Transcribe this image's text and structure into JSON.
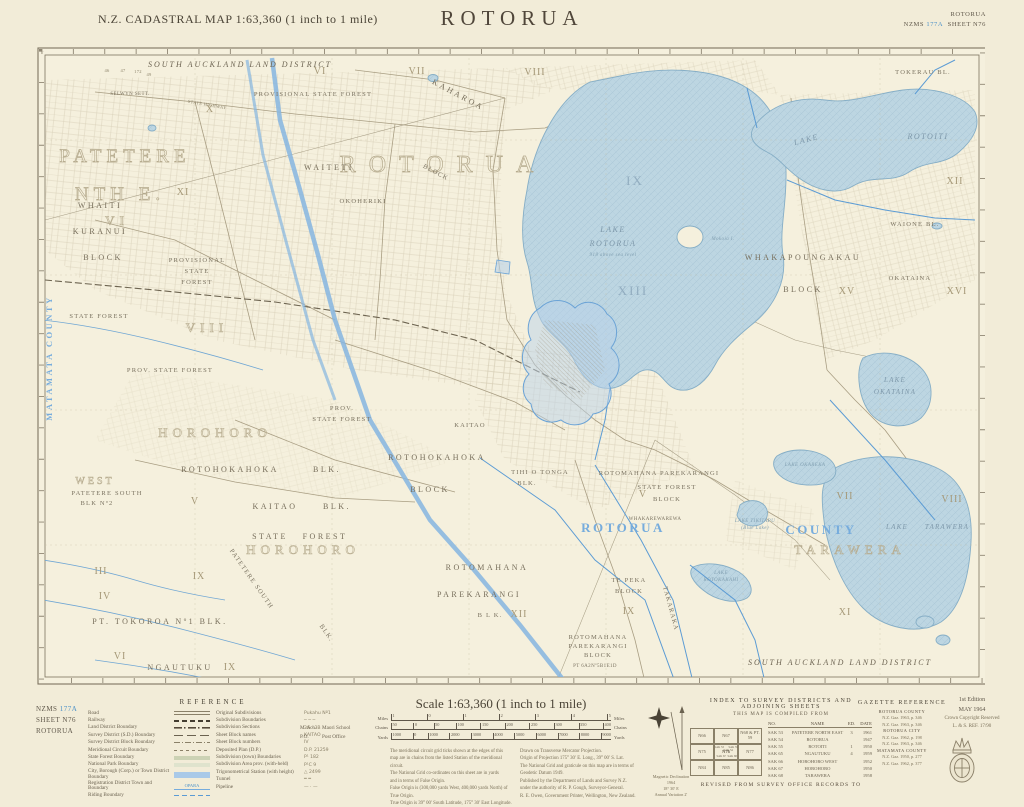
{
  "header": {
    "title": "N.Z. CADASTRAL MAP 1:63,360 (1 inch to 1 mile)",
    "name": "ROTORUA",
    "corner_title": "ROTORUA",
    "series_prefix": "NZMS ",
    "series_no": "177A",
    "sheet": "SHEET N76"
  },
  "footer": {
    "sheet_id": {
      "prefix": "NZMS ",
      "no": "177A",
      "sheet": "SHEET N76",
      "name": "ROTORUA"
    },
    "reference": {
      "title": "REFERENCE",
      "col1": [
        {
          "label": "Road",
          "sw": "sw-road",
          "sample": ""
        },
        {
          "label": "Railway",
          "sw": "sw-rail",
          "sample": ""
        },
        {
          "label": "Land District Boundary",
          "sw": "sw-dashdot-heavy",
          "sample": ""
        },
        {
          "label": "Survey District (S.D.) Boundary",
          "sw": "sw-dash-long",
          "sample": ""
        },
        {
          "label": "Survey District Block Boundary",
          "sw": "sw-dashdot",
          "sample": ""
        },
        {
          "label": "Meridional Circuit Boundary",
          "sw": "sw-dash-fine",
          "sample": ""
        },
        {
          "label": "State Forest Boundary",
          "sw": "sw-band-forest",
          "sample": ""
        },
        {
          "label": "National Park Boundary",
          "sw": "sw-band-park",
          "sample": ""
        },
        {
          "label": "City, Borough (Corp.) or Town District Boundary",
          "sw": "sw-band-blue",
          "sample": ""
        },
        {
          "label": "Registration District Town and Boundary",
          "sw": "sw-bluetown",
          "sample": "OPARA"
        },
        {
          "label": "Riding Boundary",
          "sw": "sw-bluedash",
          "sample": ""
        }
      ],
      "col2": [
        {
          "label": "Original Subdivisions",
          "sample": "Pukahu Nº1"
        },
        {
          "label": "Subdivision Boundaries",
          "sample": "─ ─ ─"
        },
        {
          "label": "Subdivision Sections",
          "sample": "3A · 3B"
        },
        {
          "label": "Sheet Block names",
          "sample": "KAITAO"
        },
        {
          "label": "Sheet Block numbers",
          "sample": "IV"
        },
        {
          "label": "Deposited Plan (D.P.)",
          "sample": "D.P. 21259"
        },
        {
          "label": "Subdivision (town) Boundaries",
          "sample": "P¹ 182"
        },
        {
          "label": "Subdivision Area prov. (with-held)",
          "sample": "P¹C 9"
        },
        {
          "label": "Trigonometrical Station (with height)",
          "sample": "△ 2499"
        },
        {
          "label": "Tunnel",
          "sample": "═ ═"
        },
        {
          "label": "Pipeline",
          "sample": "— · —"
        }
      ],
      "abbr": [
        {
          "a": "M. Sch.",
          "l": "Maori School"
        },
        {
          "a": "P.O.",
          "l": "Post Office"
        }
      ]
    },
    "scale": {
      "title": "Scale 1:63,360 (1 inch to 1 mile)",
      "miles": {
        "unit": "Miles",
        "unit2": "Miles",
        "ticks": [
          "1",
          "0",
          "1",
          "2",
          "3",
          "4",
          "5"
        ]
      },
      "chains": {
        "unit": "Chains",
        "unit2": "Chains",
        "ticks": [
          "50",
          "0",
          "50",
          "100",
          "150",
          "200",
          "250",
          "300",
          "350",
          "400"
        ]
      },
      "yards": {
        "unit": "Yards",
        "unit2": "Yards",
        "ticks": [
          "1000",
          "0",
          "1000",
          "2000",
          "3000",
          "4000",
          "5000",
          "6000",
          "7000",
          "8000",
          "9000"
        ]
      },
      "notes_left": [
        "The meridional circuit grid ticks shown at the edges of this",
        "map are in chains from the listed Station of the meridional circuit.",
        "The National Grid co-ordinates on this sheet are in yards",
        "and in terms of False Origin.",
        "False Origin is (300,000 yards West, 400,000 yards North) of True Origin.",
        "True Origin is 39° 00′ South Latitude, 175° 30′ East Longitude."
      ],
      "notes_right": [
        "Drawn on Transverse Mercator Projection.",
        "Origin of Projection 175° 30′ E. Long., 39° 00′ S. Lat.",
        "The National Grid and graticule on this map are in terms of",
        "Geodetic Datum 1949.",
        "Published by the Department of Lands and Survey N.Z.",
        "under the authority of R. P. Gough, Surveyor-General.",
        "R. E. Owen, Government Printer, Wellington, New Zealand."
      ]
    },
    "compass": {
      "declination": [
        "Magnetic Declination",
        "1964",
        "18° 30′ E",
        "Annual Variation 2′"
      ]
    },
    "index": {
      "title": "INDEX TO SURVEY DISTRICTS AND ADJOINING SHEETS",
      "subtitle": "THIS MAP IS COMPILED FROM",
      "columns": [
        "NO.",
        "NAME",
        "ED.",
        "DATE"
      ],
      "rows": [
        [
          "SAK 53",
          "PATETERE NORTH EAST",
          "3",
          "1961"
        ],
        [
          "SAK 54",
          "ROTORUA",
          "",
          "1947"
        ],
        [
          "SAK 55",
          "ROTOITI",
          "1",
          "1950"
        ],
        [
          "SAK 65",
          "NGAUTUKU",
          "4",
          "1959"
        ],
        [
          "SAK 66",
          "HOROHORO WEST",
          "",
          "1952"
        ],
        [
          "SAK 67",
          "HOROHORO",
          "",
          "1950"
        ],
        [
          "SAK 68",
          "TARAWERA",
          "",
          "1958"
        ]
      ],
      "grid": [
        "N66",
        "N67",
        "N68 & PT. 59",
        "N75",
        "N76",
        "N77",
        "N84",
        "N85",
        "N86"
      ],
      "inner": [
        "SAK 53",
        "SAK 54",
        "SAK 55",
        "SAK 67",
        "SAK 68"
      ],
      "revised": "REVISED FROM SURVEY OFFICE RECORDS TO"
    },
    "gazette": {
      "title": "GAZETTE REFERENCE",
      "lines": [
        {
          "t": "ROTORUA COUNTY",
          "k": "hd"
        },
        {
          "t": "N.Z. Gaz. 1963, p. 346",
          "k": "ref"
        },
        {
          "t": "N.Z. Gaz. 1963, p. 346",
          "k": "ref"
        },
        {
          "t": "ROTORUA CITY",
          "k": "hd"
        },
        {
          "t": "N.Z. Gaz. 1962, p. 198",
          "k": "ref"
        },
        {
          "t": "N.Z. Gaz. 1963, p. 346",
          "k": "ref"
        },
        {
          "t": "MATAMATA COUNTY",
          "k": "hd"
        },
        {
          "t": "N.Z. Gaz. 1950, p. 277",
          "k": "ref"
        },
        {
          "t": "N.Z. Gaz. 1962, p. 377",
          "k": "ref"
        }
      ]
    },
    "edition": {
      "line1": "1st Edition",
      "line2": "MAY 1964",
      "line3": "Crown Copyright Reserved",
      "line4": "L. & S. REF. 17/90"
    }
  },
  "map": {
    "labels": [
      {
        "t": "From \"Mt. Eden\" Mt. Eden Meridional Circuit",
        "x": 215,
        "y": 5,
        "c": "micro"
      },
      {
        "t": "E. Long. 176° 0′",
        "x": 305,
        "y": 4,
        "c": "micro"
      },
      {
        "t": "From \"Te Matata\" Bay of Plenty Meridional Circuit",
        "x": 690,
        "y": 5,
        "c": "micro"
      },
      {
        "t": "E. Long. 176° 10′",
        "x": 390,
        "y": 649,
        "c": "micro"
      },
      {
        "t": "From \"Te Matata\" Bay of Plenty Meridional Circuit",
        "x": 565,
        "y": 649,
        "c": "micro"
      },
      {
        "t": "SOUTH  AUCKLAND  LAND  DISTRICT",
        "x": 205,
        "y": 27,
        "c": "district"
      },
      {
        "t": "SOUTH  AUCKLAND  LAND  DISTRICT",
        "x": 805,
        "y": 625,
        "c": "district"
      },
      {
        "t": "PATETERE",
        "x": 90,
        "y": 122,
        "c": "outline-lg"
      },
      {
        "t": "NTH E.",
        "x": 85,
        "y": 160,
        "c": "outline-lg"
      },
      {
        "t": "SELWYN  SETT.",
        "x": 95,
        "y": 55,
        "c": "tiny"
      },
      {
        "t": "46",
        "x": 72,
        "y": 32,
        "c": "micro"
      },
      {
        "t": "47",
        "x": 88,
        "y": 32,
        "c": "micro"
      },
      {
        "t": "172",
        "x": 103,
        "y": 33,
        "c": "micro"
      },
      {
        "t": "49",
        "x": 114,
        "y": 36,
        "c": "micro"
      },
      {
        "t": "STATE  HIGHWAY",
        "x": 172,
        "y": 66,
        "c": "micro",
        "r": 10
      },
      {
        "t": "PROVISIONAL  STATE  FOREST",
        "x": 278,
        "y": 56,
        "c": "blk-sm"
      },
      {
        "t": "X",
        "x": 175,
        "y": 72,
        "c": "rn"
      },
      {
        "t": "VI",
        "x": 285,
        "y": 34,
        "c": "rn"
      },
      {
        "t": "VII",
        "x": 382,
        "y": 34,
        "c": "rn"
      },
      {
        "t": "VIII",
        "x": 500,
        "y": 35,
        "c": "rn"
      },
      {
        "t": "WHAITI",
        "x": 65,
        "y": 168,
        "c": "blk"
      },
      {
        "t": "KURANUI",
        "x": 65,
        "y": 194,
        "c": "blk"
      },
      {
        "t": "BLOCK",
        "x": 68,
        "y": 220,
        "c": "blk"
      },
      {
        "t": "XI",
        "x": 148,
        "y": 155,
        "c": "rn"
      },
      {
        "t": "VI",
        "x": 82,
        "y": 185,
        "c": "outline-md"
      },
      {
        "t": "PROVISIONAL",
        "x": 162,
        "y": 222,
        "c": "blk-sm"
      },
      {
        "t": "STATE",
        "x": 162,
        "y": 233,
        "c": "blk-sm"
      },
      {
        "t": "FOREST",
        "x": 162,
        "y": 244,
        "c": "blk-sm"
      },
      {
        "t": "STATE FOREST",
        "x": 64,
        "y": 278,
        "c": "blk-sm"
      },
      {
        "t": "VIII",
        "x": 172,
        "y": 292,
        "c": "outline-md"
      },
      {
        "t": "PROV.  STATE  FOREST",
        "x": 135,
        "y": 332,
        "c": "blk-sm"
      },
      {
        "t": "MATAMATA  COUNTY",
        "x": 17,
        "y": 318,
        "c": "county-v",
        "r": -90
      },
      {
        "t": "ROTORUA",
        "x": 408,
        "y": 132,
        "c": "outline-xl"
      },
      {
        "t": "WAITETI",
        "x": 294,
        "y": 130,
        "c": "blk"
      },
      {
        "t": "OKOHERIKI",
        "x": 328,
        "y": 163,
        "c": "blk-sm"
      },
      {
        "t": "KAHAROA",
        "x": 422,
        "y": 57,
        "c": "blk",
        "r": 28
      },
      {
        "t": "BLOCK",
        "x": 400,
        "y": 134,
        "c": "blk-sm",
        "r": 28
      },
      {
        "t": "PROV.",
        "x": 307,
        "y": 370,
        "c": "blk-sm"
      },
      {
        "t": "STATE  FOREST",
        "x": 307,
        "y": 381,
        "c": "blk-sm"
      },
      {
        "t": "LAKE",
        "x": 578,
        "y": 192,
        "c": "water"
      },
      {
        "t": "ROTORUA",
        "x": 578,
        "y": 206,
        "c": "water"
      },
      {
        "t": "918 above sea level",
        "x": 578,
        "y": 216,
        "c": "water-tiny"
      },
      {
        "t": "Mokoia I.",
        "x": 688,
        "y": 200,
        "c": "water-tiny"
      },
      {
        "t": "IX",
        "x": 600,
        "y": 145,
        "c": "rn-lake"
      },
      {
        "t": "XIII",
        "x": 598,
        "y": 255,
        "c": "rn-lake"
      },
      {
        "t": "LAKE",
        "x": 772,
        "y": 102,
        "c": "water",
        "r": -15
      },
      {
        "t": "ROTOITI",
        "x": 893,
        "y": 99,
        "c": "water"
      },
      {
        "t": "TOKERAU BL.",
        "x": 888,
        "y": 34,
        "c": "blk-sm"
      },
      {
        "t": "XII",
        "x": 920,
        "y": 144,
        "c": "rn"
      },
      {
        "t": "WHAKAPOUNGAKAU",
        "x": 768,
        "y": 220,
        "c": "blk"
      },
      {
        "t": "BLOCK",
        "x": 768,
        "y": 252,
        "c": "blk"
      },
      {
        "t": "WAIONE  BL.",
        "x": 880,
        "y": 186,
        "c": "blk-sm"
      },
      {
        "t": "OKATAINA",
        "x": 875,
        "y": 240,
        "c": "blk-sm"
      },
      {
        "t": "XV",
        "x": 812,
        "y": 254,
        "c": "rn"
      },
      {
        "t": "XVI",
        "x": 922,
        "y": 254,
        "c": "rn"
      },
      {
        "t": "LAKE",
        "x": 860,
        "y": 342,
        "c": "water-sm"
      },
      {
        "t": "OKATAINA",
        "x": 860,
        "y": 354,
        "c": "water-sm"
      },
      {
        "t": "HOROHORO",
        "x": 180,
        "y": 397,
        "c": "outline-md"
      },
      {
        "t": "ROTOHOKAHOKA",
        "x": 195,
        "y": 432,
        "c": "blk"
      },
      {
        "t": "BLK.",
        "x": 292,
        "y": 432,
        "c": "blk"
      },
      {
        "t": "WEST",
        "x": 60,
        "y": 444,
        "c": "outline-sm"
      },
      {
        "t": "PATETERE  SOUTH",
        "x": 72,
        "y": 455,
        "c": "blk-sm"
      },
      {
        "t": "BLK  Nº2",
        "x": 62,
        "y": 465,
        "c": "blk-sm"
      },
      {
        "t": "ROTOHOKAHOKA",
        "x": 402,
        "y": 420,
        "c": "blk"
      },
      {
        "t": "BLOCK",
        "x": 395,
        "y": 452,
        "c": "blk"
      },
      {
        "t": "KAITAO",
        "x": 435,
        "y": 387,
        "c": "blk-sm"
      },
      {
        "t": "KAITAO",
        "x": 240,
        "y": 469,
        "c": "blk"
      },
      {
        "t": "BLK.",
        "x": 302,
        "y": 469,
        "c": "blk"
      },
      {
        "t": "STATE",
        "x": 235,
        "y": 499,
        "c": "blk"
      },
      {
        "t": "FOREST",
        "x": 290,
        "y": 499,
        "c": "blk"
      },
      {
        "t": "V",
        "x": 160,
        "y": 464,
        "c": "rn"
      },
      {
        "t": "III",
        "x": 66,
        "y": 534,
        "c": "rn"
      },
      {
        "t": "IV",
        "x": 70,
        "y": 559,
        "c": "rn"
      },
      {
        "t": "IX",
        "x": 164,
        "y": 539,
        "c": "rn"
      },
      {
        "t": "HOROHORO",
        "x": 268,
        "y": 514,
        "c": "outline-md"
      },
      {
        "t": "PATETERE  SOUTH",
        "x": 215,
        "y": 540,
        "c": "blk-sm",
        "r": 55
      },
      {
        "t": "BLK.",
        "x": 290,
        "y": 594,
        "c": "blk-sm",
        "r": 55
      },
      {
        "t": "PT.  TOKOROA  Nº1  BLK.",
        "x": 125,
        "y": 584,
        "c": "blk"
      },
      {
        "t": "VI",
        "x": 85,
        "y": 619,
        "c": "rn"
      },
      {
        "t": "NGAUTUKU",
        "x": 145,
        "y": 630,
        "c": "blk"
      },
      {
        "t": "IX",
        "x": 195,
        "y": 630,
        "c": "rn"
      },
      {
        "t": "TIHI O TONGA",
        "x": 505,
        "y": 434,
        "c": "blk-sm"
      },
      {
        "t": "BLK.",
        "x": 492,
        "y": 445,
        "c": "blk-sm"
      },
      {
        "t": "ROTOMAHANA  PAREKARANGI",
        "x": 624,
        "y": 435,
        "c": "blk-sm"
      },
      {
        "t": "STATE  FOREST",
        "x": 632,
        "y": 449,
        "c": "blk-sm"
      },
      {
        "t": "BLOCK",
        "x": 632,
        "y": 461,
        "c": "blk-sm"
      },
      {
        "t": "V",
        "x": 608,
        "y": 457,
        "c": "rn"
      },
      {
        "t": "WHAKAREWAREWA",
        "x": 620,
        "y": 480,
        "c": "tiny"
      },
      {
        "t": "ROTORUA",
        "x": 588,
        "y": 492,
        "c": "county"
      },
      {
        "t": "COUNTY",
        "x": 786,
        "y": 494,
        "c": "county"
      },
      {
        "t": "VII",
        "x": 810,
        "y": 459,
        "c": "rn"
      },
      {
        "t": "VIII",
        "x": 917,
        "y": 462,
        "c": "rn"
      },
      {
        "t": "LAKE OKAREKA",
        "x": 770,
        "y": 426,
        "c": "water-tiny"
      },
      {
        "t": "LAKE TIKITAPU",
        "x": 720,
        "y": 482,
        "c": "water-tiny"
      },
      {
        "t": "(Blue Lake)",
        "x": 720,
        "y": 489,
        "c": "water-tiny"
      },
      {
        "t": "LAKE",
        "x": 686,
        "y": 534,
        "c": "water-tiny"
      },
      {
        "t": "ROTOKAKAHI",
        "x": 686,
        "y": 541,
        "c": "water-tiny"
      },
      {
        "t": "LAKE",
        "x": 862,
        "y": 489,
        "c": "water-sm"
      },
      {
        "t": "TARAWERA",
        "x": 912,
        "y": 489,
        "c": "water-sm"
      },
      {
        "t": "TARAWERA",
        "x": 815,
        "y": 514,
        "c": "outline-md"
      },
      {
        "t": "TE PEKA",
        "x": 594,
        "y": 542,
        "c": "blk-sm"
      },
      {
        "t": "BLOCK",
        "x": 594,
        "y": 553,
        "c": "blk-sm"
      },
      {
        "t": "IX",
        "x": 594,
        "y": 574,
        "c": "rn"
      },
      {
        "t": "TAKARAKA",
        "x": 634,
        "y": 569,
        "c": "blk-sm",
        "r": 75
      },
      {
        "t": "ROTOMAHANA",
        "x": 452,
        "y": 530,
        "c": "blk"
      },
      {
        "t": "PAREKARANGI",
        "x": 444,
        "y": 557,
        "c": "blk"
      },
      {
        "t": "B L K.",
        "x": 455,
        "y": 577,
        "c": "blk-sm"
      },
      {
        "t": "XII",
        "x": 484,
        "y": 577,
        "c": "rn"
      },
      {
        "t": "ROTOMAHANA",
        "x": 563,
        "y": 599,
        "c": "blk-sm"
      },
      {
        "t": "PAREKARANGI",
        "x": 563,
        "y": 608,
        "c": "blk-sm"
      },
      {
        "t": "BLOCK",
        "x": 563,
        "y": 617,
        "c": "blk-sm"
      },
      {
        "t": "PT 6A2Nº5B1E1D",
        "x": 560,
        "y": 627,
        "c": "tiny"
      },
      {
        "t": "XI",
        "x": 810,
        "y": 575,
        "c": "rn"
      }
    ]
  }
}
